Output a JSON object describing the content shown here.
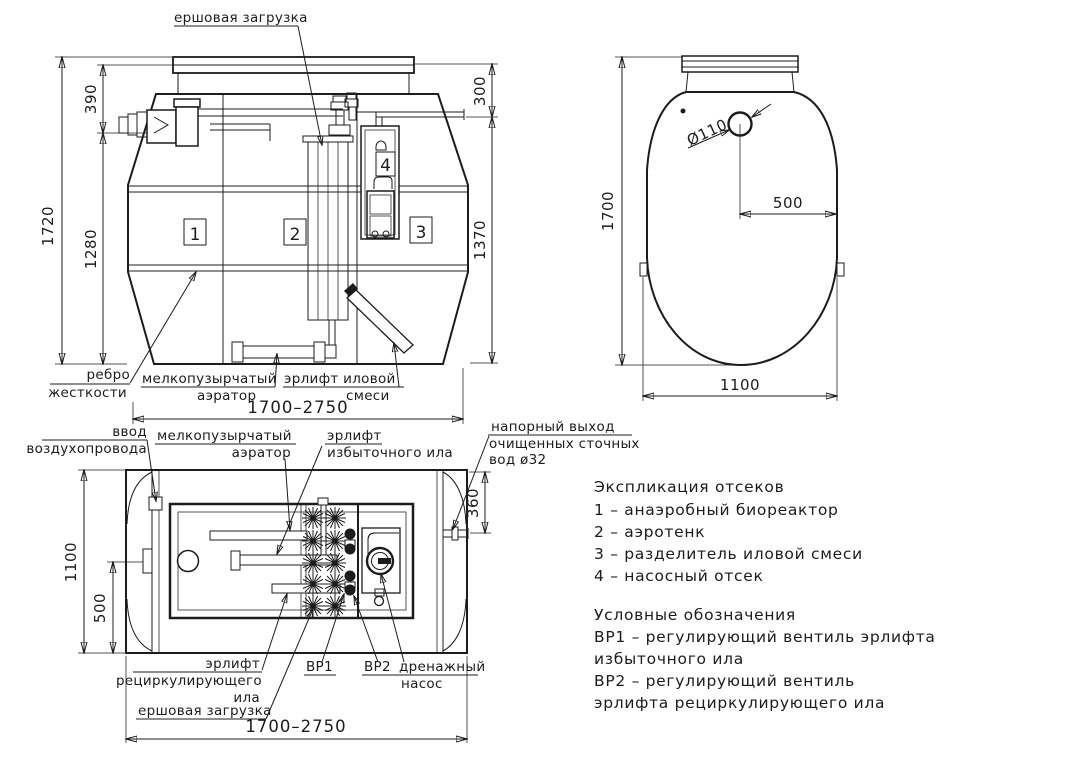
{
  "front_view": {
    "labels": {
      "ersh": "ершовая загрузка",
      "rib1": "ребро",
      "rib2": "жесткости",
      "aer1": "мелкопузырчатый",
      "aer2": "аэратор",
      "airlift1": "эрлифт иловой",
      "airlift2": "смеси"
    },
    "compartments": {
      "c1": "1",
      "c2": "2",
      "c3": "3",
      "c4": "4"
    },
    "dims": {
      "total_h": "1720",
      "top": "390",
      "mid": "1280",
      "lid": "300",
      "right_h": "1370",
      "width": "1700–2750"
    }
  },
  "top_view": {
    "dims": {
      "length": "1700",
      "hole": "Ø110",
      "offset": "500",
      "width": "1100"
    }
  },
  "plan_view": {
    "labels": {
      "air1": "ввод",
      "air2": "воздухопровода",
      "aer1": "мелкопузырчатый",
      "aer2": "аэратор",
      "exc1": "эрлифт",
      "exc2": "избыточного ила",
      "out1": "напорный выход",
      "out2": "очищенных сточных",
      "out3": "вод ø32",
      "rec1": "эрлифт",
      "rec2": "рециркулирующего",
      "rec3": "ила",
      "ersh": "ершовая загрузка",
      "vr1": "ВР1",
      "vr2": "ВР2",
      "pump1": "дренажный",
      "pump2": "насос"
    },
    "dims": {
      "width": "1100",
      "offset": "500",
      "outlet": "360",
      "length": "1700–2750"
    }
  },
  "legend": {
    "explication_title": "Экспликация отсеков",
    "explication": [
      "1 – анаэробный биореактор",
      "2 – аэротенк",
      "3 – разделитель иловой смеси",
      "4 – насосный отсек"
    ],
    "symbols_title": "Условные обозначения",
    "symbols": [
      "ВР1 – регулирующий вентиль эрлифта",
      "избыточного ила",
      "ВР2 – регулирующий вентиль",
      "эрлифта рециркулирующего ила"
    ]
  },
  "colors": {
    "line": "#1c1c1c",
    "background": "#ffffff"
  }
}
